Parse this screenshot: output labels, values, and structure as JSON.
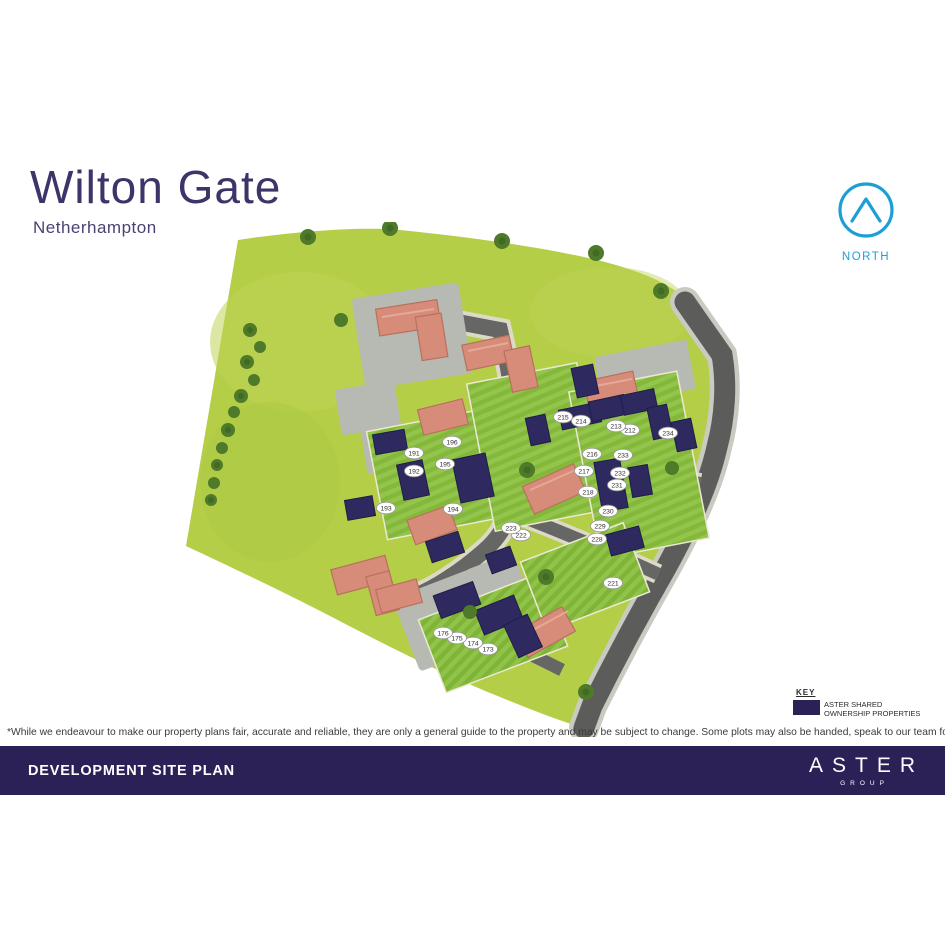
{
  "header": {
    "title": "Wilton Gate",
    "subtitle": "Netherhampton"
  },
  "north": {
    "label": "NORTH",
    "color": "#1d9fd6"
  },
  "key": {
    "heading": "KEY",
    "swatch_color": "#2b2157",
    "label_line1": "ASTER SHARED",
    "label_line2": "OWNERSHIP PROPERTIES"
  },
  "disclaimer": "*While we endeavour to make our property plans fair, accurate and reliable, they are only a general guide to the property and may be subject to change. Some plots may also be handed, speak to our team for more information.",
  "footer": {
    "title": "DEVELOPMENT SITE PLAN",
    "brand": "ASTER",
    "brand_sub": "GROUP",
    "bg_color": "#2b2157"
  },
  "site_plan": {
    "colors": {
      "field_green": "#b5ce48",
      "lawn_green_dark": "#7fb437",
      "lawn_green_light": "#8fc34a",
      "road_grey": "#5c5d5b",
      "parking_grey": "#b7b9b3",
      "house_roof_salmon": "#d68c79",
      "aster_navy": "#2e295e",
      "tree_green": "#4e7a2a"
    },
    "plots": [
      {
        "label": "173",
        "x": 308,
        "y": 427
      },
      {
        "label": "174",
        "x": 293,
        "y": 421
      },
      {
        "label": "175",
        "x": 277,
        "y": 416
      },
      {
        "label": "176",
        "x": 263,
        "y": 411
      },
      {
        "label": "191",
        "x": 234,
        "y": 231
      },
      {
        "label": "192",
        "x": 234,
        "y": 249
      },
      {
        "label": "193",
        "x": 206,
        "y": 286
      },
      {
        "label": "194",
        "x": 273,
        "y": 287
      },
      {
        "label": "195",
        "x": 265,
        "y": 242
      },
      {
        "label": "196",
        "x": 272,
        "y": 220
      },
      {
        "label": "212",
        "x": 450,
        "y": 208
      },
      {
        "label": "213",
        "x": 436,
        "y": 204
      },
      {
        "label": "214",
        "x": 401,
        "y": 199
      },
      {
        "label": "215",
        "x": 383,
        "y": 195
      },
      {
        "label": "216",
        "x": 412,
        "y": 232
      },
      {
        "label": "217",
        "x": 404,
        "y": 249
      },
      {
        "label": "218",
        "x": 408,
        "y": 270
      },
      {
        "label": "221",
        "x": 433,
        "y": 361
      },
      {
        "label": "222",
        "x": 341,
        "y": 313
      },
      {
        "label": "223",
        "x": 331,
        "y": 306
      },
      {
        "label": "228",
        "x": 417,
        "y": 317
      },
      {
        "label": "229",
        "x": 420,
        "y": 304
      },
      {
        "label": "230",
        "x": 428,
        "y": 289
      },
      {
        "label": "231",
        "x": 437,
        "y": 263
      },
      {
        "label": "232",
        "x": 440,
        "y": 251
      },
      {
        "label": "233",
        "x": 443,
        "y": 233
      },
      {
        "label": "234",
        "x": 488,
        "y": 211
      }
    ]
  }
}
